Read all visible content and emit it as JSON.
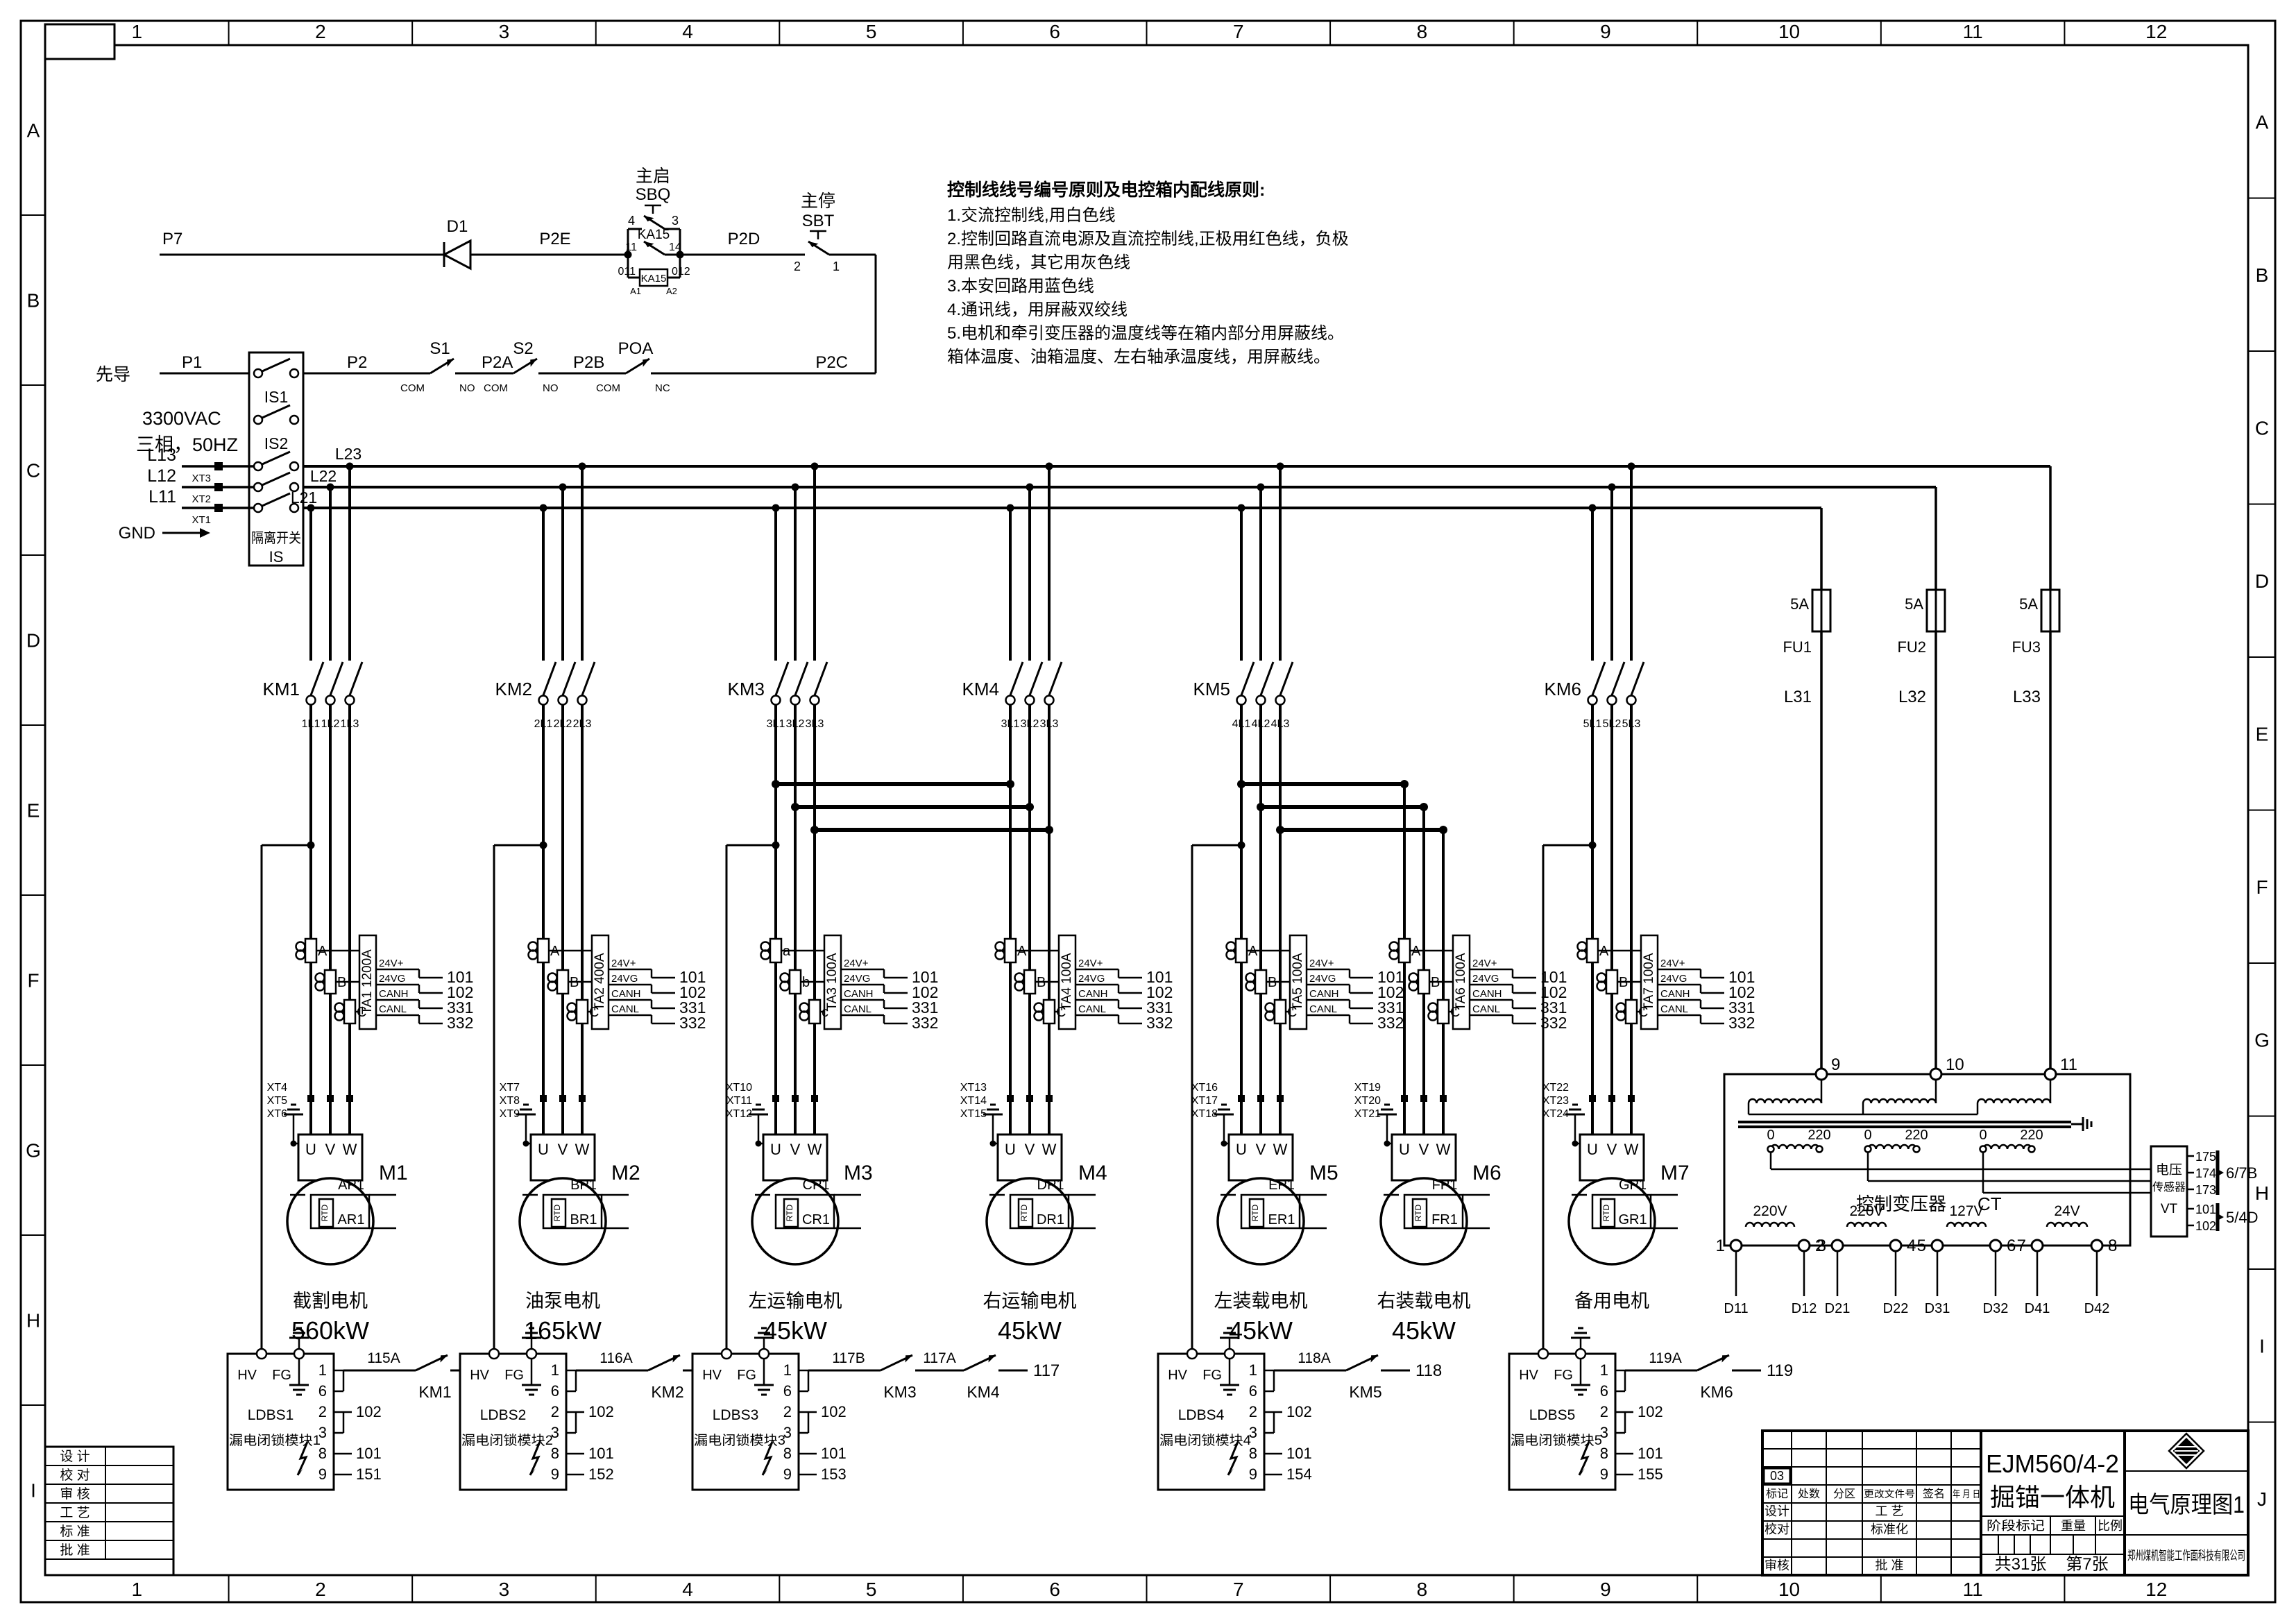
{
  "frame": {
    "cols": [
      "1",
      "2",
      "3",
      "4",
      "5",
      "6",
      "7",
      "8",
      "9",
      "10",
      "11",
      "12"
    ],
    "rows_left": [
      "A",
      "B",
      "C",
      "D",
      "E",
      "F",
      "G",
      "H",
      "I"
    ],
    "rows_right": [
      "A",
      "B",
      "C",
      "D",
      "E",
      "F",
      "G",
      "H",
      "I",
      "J"
    ]
  },
  "notes": {
    "title": "控制线线号编号原则及电控箱内配线原则:",
    "lines": [
      "1.交流控制线,用白色线",
      "2.控制回路直流电源及直流控制线,正极用红色线，负极",
      "用黑色线，其它用灰色线",
      "3.本安回路用蓝色线",
      "4.通讯线，用屏蔽双绞线",
      "5.电机和牵引变压器的温度线等在箱内部分用屏蔽线。",
      "箱体温度、油箱温度、左右轴承温度线，用屏蔽线。"
    ]
  },
  "control": {
    "p7": "P7",
    "d1": "D1",
    "p2e": "P2E",
    "p2d": "P2D",
    "p2c": "P2C",
    "p1": "P1",
    "p2": "P2",
    "p2a": "P2A",
    "p2b": "P2B",
    "pilot": "先导",
    "sbq": {
      "name": "主启",
      "id": "SBQ",
      "tl": "4",
      "tr": "3"
    },
    "ka15": {
      "id": "KA15",
      "tl": "11",
      "tr": "14",
      "coil_id": "KA15",
      "wl": "011",
      "wr": "012",
      "al": "A1",
      "ar": "A2"
    },
    "sbt": {
      "name": "主停",
      "id": "SBT",
      "tl": "2",
      "tr": "1"
    },
    "s1": {
      "id": "S1",
      "l": "COM",
      "r": "NO"
    },
    "s2": {
      "id": "S2",
      "l": "COM",
      "r": "NO"
    },
    "poa": {
      "id": "POA",
      "l": "COM",
      "r": "NC"
    },
    "supply_v": "3300VAC",
    "supply_ph": "三相，50HZ",
    "inputs": [
      {
        "w": "L13",
        "xt": "XT3"
      },
      {
        "w": "L12",
        "xt": "XT2"
      },
      {
        "w": "L11",
        "xt": "XT1"
      }
    ],
    "gnd": "GND",
    "iso": {
      "is1": "IS1",
      "is2": "IS2",
      "name": "隔离开关",
      "id": "IS"
    },
    "buses": [
      "L23",
      "L22",
      "L21"
    ]
  },
  "uvw": [
    "U",
    "V",
    "W"
  ],
  "branches": [
    {
      "km": "KM1",
      "wires": [
        "1L1",
        "1L2",
        "1L3"
      ],
      "xt": [
        "XT4",
        "XT5",
        "XT6"
      ],
      "ta": "TA1 1200A",
      "toroids": [
        "A",
        "B",
        "C"
      ],
      "motor": {
        "id": "M1",
        "p": "AP1",
        "r": "AR1",
        "rtd": "RTD",
        "name": "截割电机",
        "power": "560kW"
      }
    },
    {
      "km": "KM2",
      "wires": [
        "2L1",
        "2L2",
        "2L3"
      ],
      "xt": [
        "XT7",
        "XT8",
        "XT9"
      ],
      "ta": "TA2 400A",
      "toroids": [
        "A",
        "B",
        "C"
      ],
      "motor": {
        "id": "M2",
        "p": "BP1",
        "r": "BR1",
        "rtd": "RTD",
        "name": "油泵电机",
        "power": "165kW"
      }
    },
    {
      "km": "KM3",
      "wires": [
        "3L1",
        "3L2",
        "3L3"
      ],
      "xt": [
        "XT10",
        "XT11",
        "XT12"
      ],
      "ta": "TA3 100A",
      "toroids": [
        "a",
        "b",
        "c"
      ],
      "motor": {
        "id": "M3",
        "p": "CP1",
        "r": "CR1",
        "rtd": "RTD",
        "name": "左运输电机",
        "power": "45kW"
      }
    },
    {
      "km": "KM4",
      "wires": [
        "3L1",
        "3L2",
        "3L3"
      ],
      "xt": [
        "XT13",
        "XT14",
        "XT15"
      ],
      "ta": "TA4 100A",
      "toroids": [
        "A",
        "B",
        "C"
      ],
      "motor": {
        "id": "M4",
        "p": "DP1",
        "r": "DR1",
        "rtd": "RTD",
        "name": "右运输电机",
        "power": "45kW"
      }
    },
    {
      "km": "KM5",
      "wires": [
        "4L1",
        "4L2",
        "4L3"
      ],
      "xt": [
        "XT16",
        "XT17",
        "XT18"
      ],
      "ta": "TA5 100A",
      "toroids": [
        "A",
        "B",
        "C"
      ],
      "motor": {
        "id": "M5",
        "p": "EP1",
        "r": "ER1",
        "rtd": "RTD",
        "name": "左装载电机",
        "power": "45kW"
      }
    },
    {
      "km": "",
      "wires": [],
      "xt": [
        "XT19",
        "XT20",
        "XT21"
      ],
      "ta": "TA6 100A",
      "toroids": [
        "A",
        "B",
        "C"
      ],
      "motor": {
        "id": "M6",
        "p": "FP1",
        "r": "FR1",
        "rtd": "RTD",
        "name": "右装载电机",
        "power": "45kW"
      }
    },
    {
      "km": "KM6",
      "wires": [
        "5L1",
        "5L2",
        "5L3"
      ],
      "xt": [
        "XT22",
        "XT23",
        "XT24"
      ],
      "ta": "TA7 100A",
      "toroids": [
        "A",
        "B",
        "C"
      ],
      "motor": {
        "id": "M7",
        "p": "GP1",
        "r": "GR1",
        "rtd": "RTD",
        "name": "备用电机",
        "power": ""
      }
    }
  ],
  "ta_outputs": [
    {
      "pin": "24V+",
      "wire": "101"
    },
    {
      "pin": "24VG",
      "wire": "102"
    },
    {
      "pin": "CANH",
      "wire": "331"
    },
    {
      "pin": "CANL",
      "wire": "332"
    }
  ],
  "ldbs": [
    {
      "id": "LDBS1",
      "name": "漏电闭锁模块1",
      "hv": "HV",
      "fg": "FG",
      "pins": [
        "1",
        "6",
        "2",
        "3",
        "8",
        "9"
      ],
      "w102": "102",
      "w101": "101",
      "w9": "151",
      "win": "115A",
      "km1": "KM1",
      "wmid": "",
      "km2": "",
      "wout": "115"
    },
    {
      "id": "LDBS2",
      "name": "漏电闭锁模块2",
      "hv": "HV",
      "fg": "FG",
      "pins": [
        "1",
        "6",
        "2",
        "3",
        "8",
        "9"
      ],
      "w102": "102",
      "w101": "101",
      "w9": "152",
      "win": "116A",
      "km1": "KM2",
      "wmid": "",
      "km2": "",
      "wout": "116"
    },
    {
      "id": "LDBS3",
      "name": "漏电闭锁模块3",
      "hv": "HV",
      "fg": "FG",
      "pins": [
        "1",
        "6",
        "2",
        "3",
        "8",
        "9"
      ],
      "w102": "102",
      "w101": "101",
      "w9": "153",
      "win": "117B",
      "km1": "KM3",
      "wmid": "117A",
      "km2": "KM4",
      "wout": "117"
    },
    {
      "id": "LDBS4",
      "name": "漏电闭锁模块4",
      "hv": "HV",
      "fg": "FG",
      "pins": [
        "1",
        "6",
        "2",
        "3",
        "8",
        "9"
      ],
      "w102": "102",
      "w101": "101",
      "w9": "154",
      "win": "118A",
      "km1": "KM5",
      "wmid": "",
      "km2": "",
      "wout": "118"
    },
    {
      "id": "LDBS5",
      "name": "漏电闭锁模块5",
      "hv": "HV",
      "fg": "FG",
      "pins": [
        "1",
        "6",
        "2",
        "3",
        "8",
        "9"
      ],
      "w102": "102",
      "w101": "101",
      "w9": "155",
      "win": "119A",
      "km1": "KM6",
      "wmid": "",
      "km2": "",
      "wout": "119"
    }
  ],
  "fuses": [
    {
      "id": "FU1",
      "rating": "5A",
      "wire": "L31"
    },
    {
      "id": "FU2",
      "rating": "5A",
      "wire": "L32"
    },
    {
      "id": "FU3",
      "rating": "5A",
      "wire": "L33"
    }
  ],
  "ct": {
    "name": "控制变压器",
    "id": "CT",
    "tops": [
      "9",
      "10",
      "11"
    ],
    "taps": [
      {
        "z": "0",
        "v": "220"
      },
      {
        "z": "0",
        "v": "220"
      },
      {
        "z": "0",
        "v": "220"
      }
    ],
    "windings": [
      {
        "a": "1",
        "label": "220V",
        "b": "2"
      },
      {
        "a": "3",
        "label": "220V",
        "b": "4"
      },
      {
        "a": "5",
        "label": "127V",
        "b": "6"
      },
      {
        "a": "7",
        "label": "24V",
        "b": "8"
      }
    ],
    "wires": [
      "D11",
      "D12",
      "D21",
      "D22",
      "D31",
      "D32",
      "D41",
      "D42"
    ]
  },
  "vt": {
    "l1": "电压",
    "l2": "传感器",
    "id": "VT",
    "pins": [
      "175",
      "174",
      "173",
      "101",
      "102"
    ],
    "g1": "6/7B",
    "g2": "5/4D"
  },
  "title_block": {
    "rev": "03",
    "h1": "标记",
    "h2": "处数",
    "h3": "分区",
    "h4": "更改文件号",
    "h5": "签名",
    "h6": "年 月 日",
    "r1l": "设计",
    "r1r": "工 艺",
    "r2l": "校对",
    "r2r": "标准化",
    "r3l": "审核",
    "r3r": "批 准",
    "product_model": "EJM560/4-2",
    "product_name": "掘锚一体机",
    "stage": "阶段标记",
    "weight": "重量",
    "scale": "比例",
    "sheets": "共31张",
    "sheet_no": "第7张",
    "title": "电气原理图1",
    "company": "郑州煤机智能工作面科技有限公司"
  },
  "sign_table": [
    "设 计",
    "校 对",
    "审 核",
    "工 艺",
    "标 准",
    "批 准"
  ]
}
